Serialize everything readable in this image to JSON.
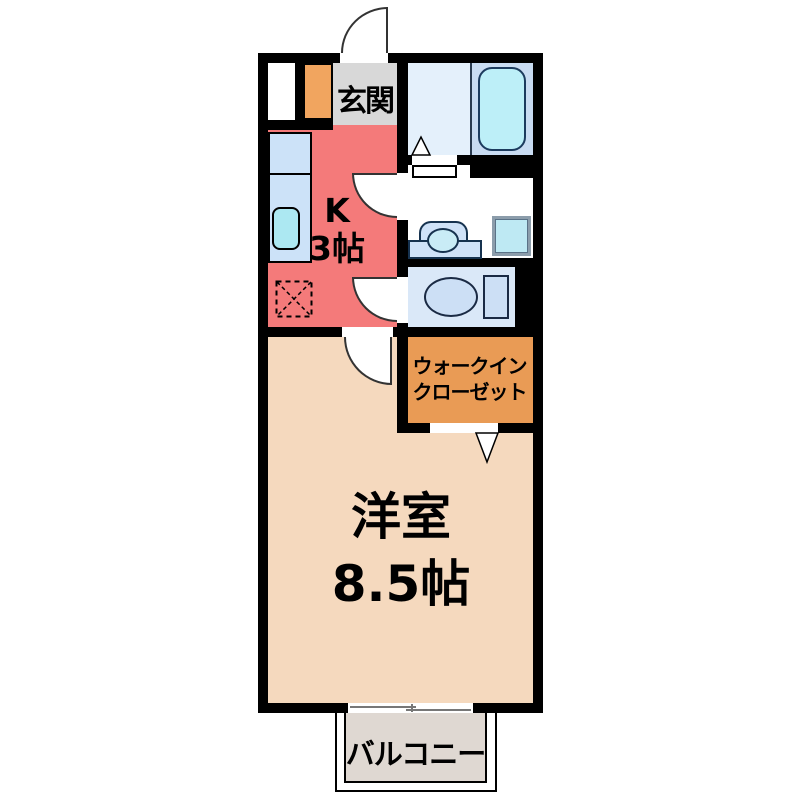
{
  "plan": {
    "type": "apartment-floorplan",
    "rooms": {
      "entrance": {
        "label": "玄関"
      },
      "kitchen": {
        "label": "K",
        "size": "3帖"
      },
      "walk_in_closet": {
        "label_line1": "ウォークイン",
        "label_line2": "クローゼット"
      },
      "western_room": {
        "label": "洋室",
        "size": "8.5帖"
      },
      "balcony": {
        "label": "バルコニー"
      }
    },
    "fixtures": [
      "entrance-door",
      "storage-niche",
      "shoe-cabinet",
      "kitchen-counter",
      "kitchen-sink",
      "refrigerator-space",
      "bathtub",
      "bath-folding-door",
      "washbasin-vanity",
      "washing-machine-space",
      "toilet",
      "interior-doors",
      "closet-folding-door",
      "sliding-window",
      "balcony-fence"
    ],
    "colors": {
      "wall": "#000000",
      "entrance_floor": "#D8D8D8",
      "kitchen_floor": "#F47A7A",
      "room_floor": "#F5D9BE",
      "closet_floor": "#E99B55",
      "shoe_cabinet": "#F1A55F",
      "bath_floor_left": "#E4F0FB",
      "bath_floor_right": "#C9DCF2",
      "bathtub": "#BDEFF8",
      "counter": "#CCE2F8",
      "sink": "#ACE8F2",
      "toilet_floor": "#DAE8F8",
      "fixture_blue": "#CCDFF5",
      "washing_machine": "#BEE9F3",
      "balcony_floor": "#DFD8D2"
    }
  }
}
